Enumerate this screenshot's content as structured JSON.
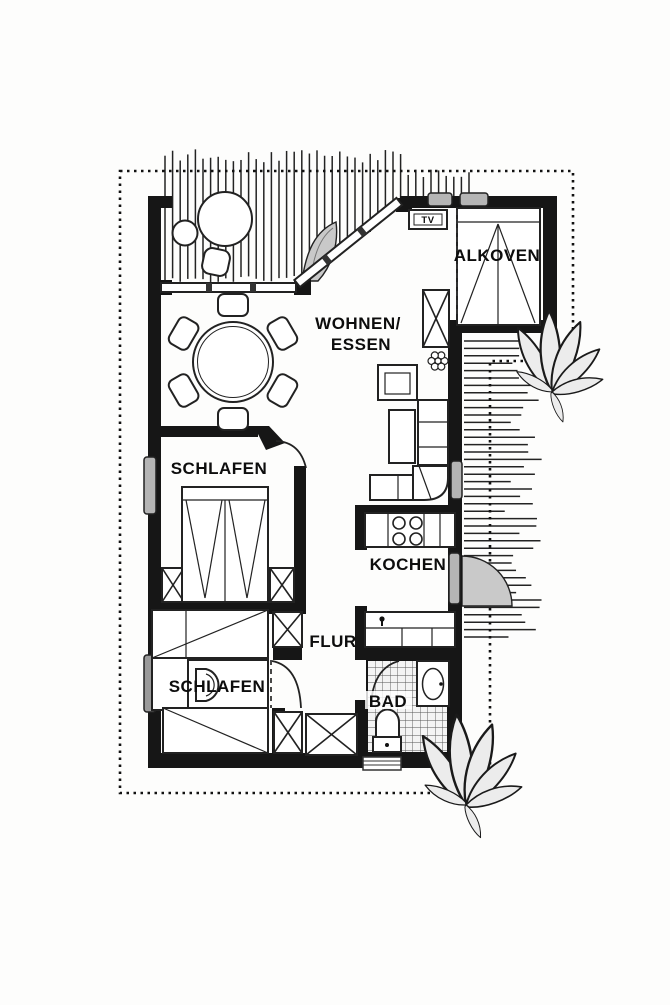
{
  "document": {
    "type": "apartment-floor-plan",
    "language": "de"
  },
  "rooms": {
    "alkoven": {
      "label": "ALKOVEN"
    },
    "wohnen_essen": {
      "label_line1": "WOHNEN/",
      "label_line2": "ESSEN"
    },
    "schlafen_1": {
      "label": "SCHLAFEN"
    },
    "kochen": {
      "label": "KOCHEN"
    },
    "flur": {
      "label": "FLUR"
    },
    "schlafen_2": {
      "label": "SCHLAFEN"
    },
    "bad": {
      "label": "BAD"
    }
  },
  "annotations": {
    "tv": "TV"
  },
  "icons": [
    "double-bed",
    "alcove-bed",
    "single-bed",
    "wardrobe-x",
    "dining-table",
    "chair",
    "armchair",
    "corner-sofa",
    "coffee-table",
    "stove-burners",
    "kitchen-sink",
    "washbasin",
    "toilet",
    "window",
    "door-swing-arc",
    "tree",
    "shrub",
    "lily-plant",
    "flower-pot",
    "terrace-hatching",
    "property-boundary-dotted"
  ],
  "palette": {
    "wall": "#161616",
    "paper": "#ffffff",
    "hatch": "#232323",
    "window_fill": "#b5b5b5",
    "shade_fill": "#c9c9c9",
    "plant_fill": "#ececec",
    "tile_line": "#555555",
    "text": "#0d0d0d"
  }
}
